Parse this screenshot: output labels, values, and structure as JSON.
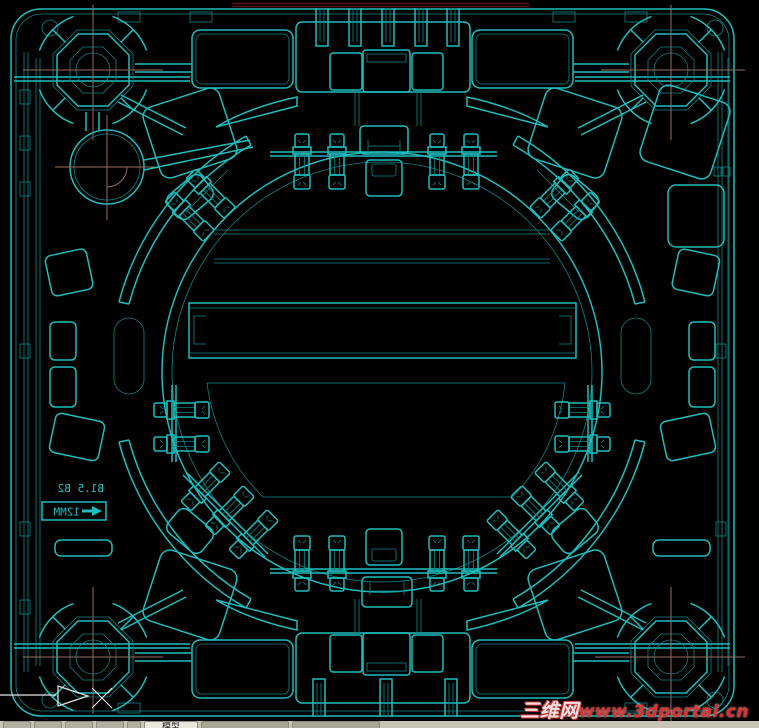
{
  "drawing": {
    "description": "CAD top view of injection mold plate with central circular cavity ring, four corner guide bosses and clamp stations"
  },
  "annotations": {
    "note1": "B1.5 B2",
    "note2": "12MM"
  },
  "watermark": {
    "site_zh": "三维网",
    "site_url": "www.3dportal.cn"
  },
  "taskbar": {
    "model_tab": "模型"
  },
  "colors": {
    "cyan": "#1fbdbd",
    "cyan_bright": "#5fe0e0",
    "cyan_dim": "#0e8585",
    "centerline": "#9a6a5f",
    "maroon": "#5a1414",
    "watermark_red": "#d03838",
    "taskbar_bg": "#c9c5b6",
    "white": "#e8e8e8"
  }
}
